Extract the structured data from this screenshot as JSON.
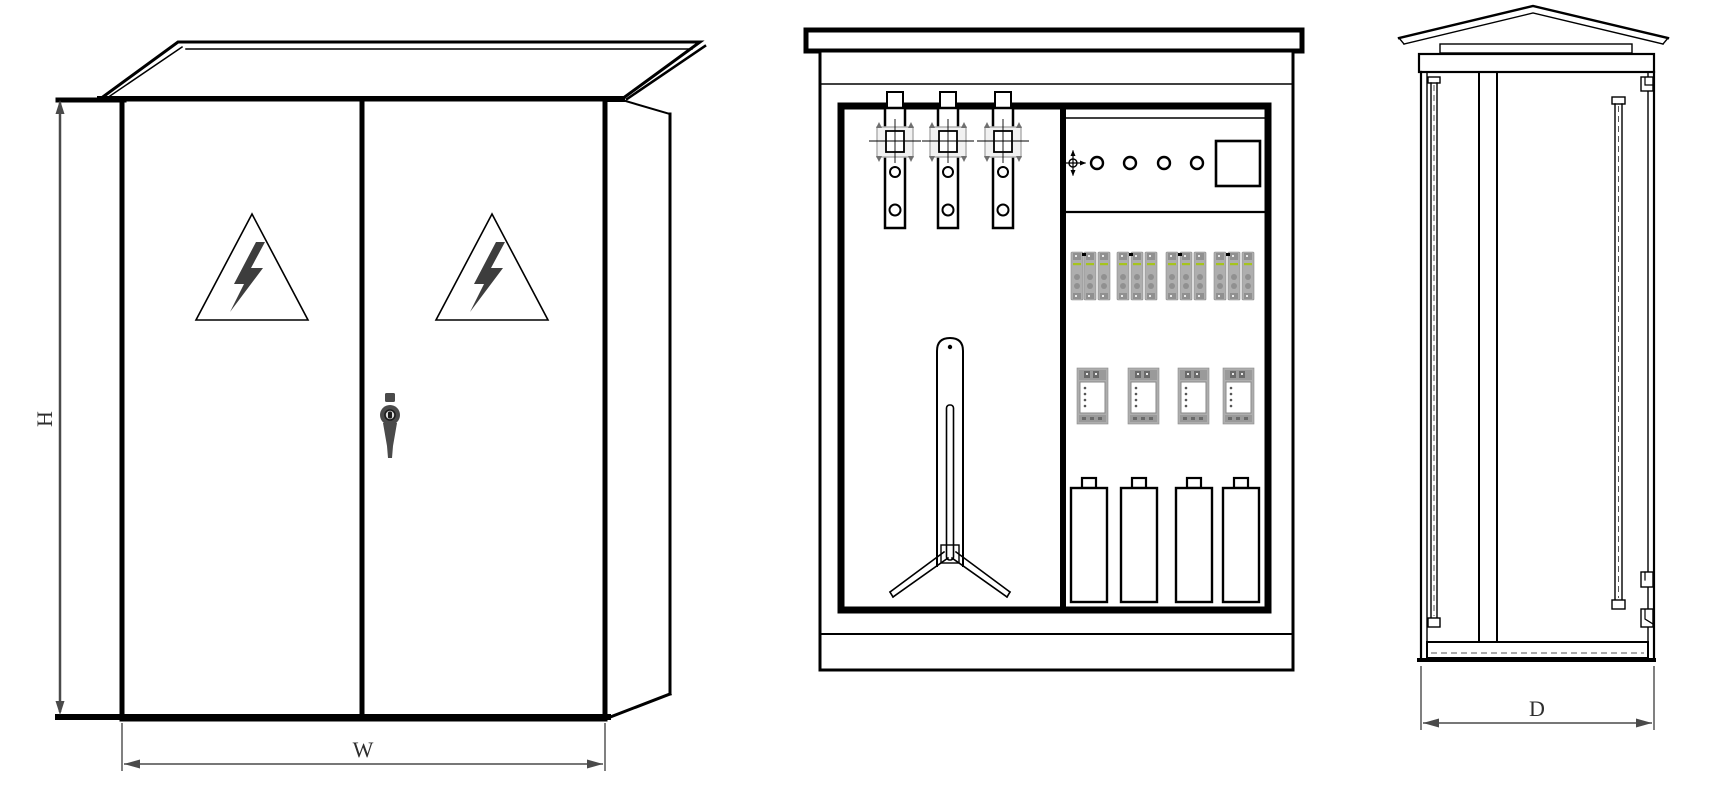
{
  "drawing": {
    "kind": "engineering-three-view-line-drawing",
    "subject": "outdoor-electrical-distribution-cabinet",
    "dimensions": {
      "height_label": "H",
      "width_label": "W",
      "depth_label": "D"
    },
    "views": {
      "front": {
        "name": "front-exterior-view",
        "doors": 2,
        "warning_triangles": 2,
        "icons": [
          "warning-triangle-icon",
          "lightning-bolt-icon",
          "door-handle"
        ]
      },
      "internal": {
        "name": "internal-layout-view",
        "busbars": 3,
        "din_breakers": 12,
        "din_breaker_groups": 4,
        "molded_case_breakers": 4,
        "capacitors": 4,
        "panel_port_circles": 4,
        "icons": [
          "datum-crosshair-icon",
          "grounding-rod-tripod",
          "meter-box"
        ]
      },
      "side": {
        "name": "side-sectional-view",
        "hinges": 3,
        "door_panels": 2
      }
    },
    "colors": {
      "line": "#000000",
      "dimension": "#4a4a4a",
      "equipment_gray": "#aeaeae",
      "equipment_dark": "#8a8a8a",
      "indicator_green": "#a6c41d",
      "bolt_gray": "#3d3d3d",
      "background": "#ffffff"
    }
  }
}
